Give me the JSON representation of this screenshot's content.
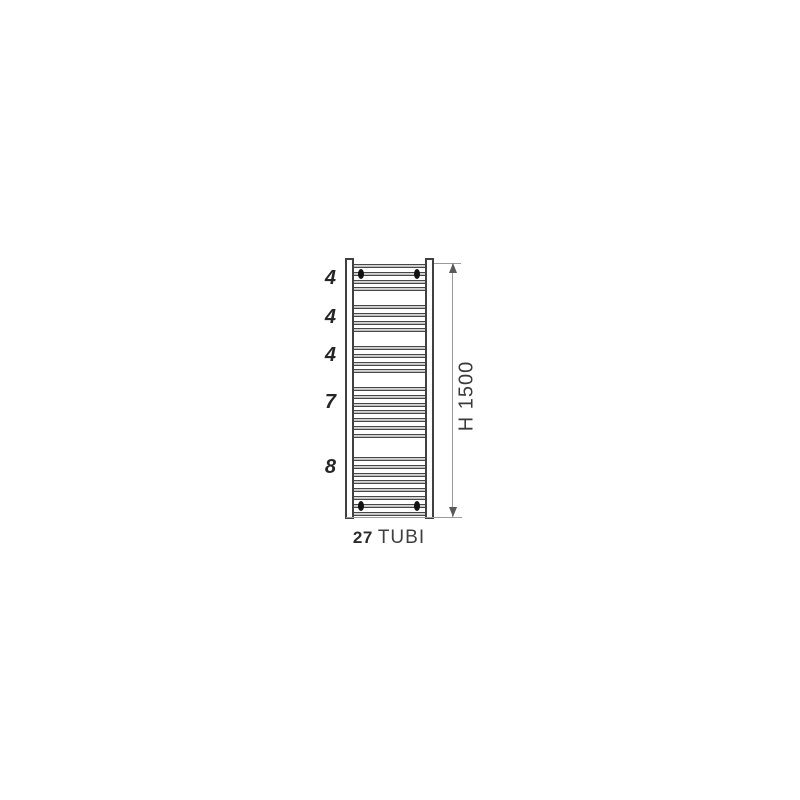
{
  "diagram": {
    "type": "towel-radiator-technical-drawing",
    "groups": [
      {
        "label": "4",
        "tubes": 4,
        "bracket_tube": 2
      },
      {
        "label": "4",
        "tubes": 4
      },
      {
        "label": "4",
        "tubes": 4
      },
      {
        "label": "7",
        "tubes": 7
      },
      {
        "label": "8",
        "tubes": 8,
        "bracket_tube": 7
      }
    ],
    "total_tubes": 27,
    "total_tubes_label": {
      "count": "27",
      "unit": "TUBI"
    },
    "height_dimension": "H 1500",
    "colors": {
      "background": "#ffffff",
      "outline": "#404040",
      "tube_edge": "#474747",
      "tube_fill": "#b2b2b2",
      "dimension_line": "#9a9a9a",
      "arrow": "#5a5a5a",
      "bracket_dot": "#111111",
      "text": "#2e2e2e"
    }
  }
}
